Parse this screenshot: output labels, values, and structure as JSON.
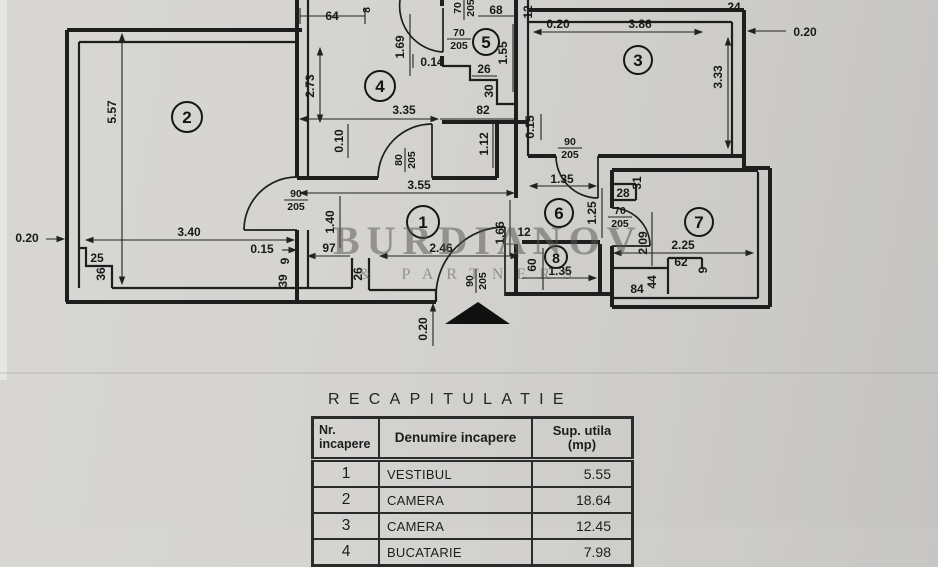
{
  "plan": {
    "rooms": [
      "1",
      "2",
      "3",
      "4",
      "5",
      "6",
      "7",
      "8"
    ],
    "dims": [
      "5.57",
      "0.20",
      "3.40",
      "0.15",
      "25",
      "36",
      "9",
      "39",
      "64",
      "8",
      "2.73",
      "1.69",
      "0.14",
      "68",
      "1.55",
      "26",
      "30",
      "3.35",
      "82",
      "0.10",
      "1.12",
      "12",
      "0.20",
      "3.86",
      "24",
      "0.20",
      "3.33",
      "0.15",
      "1.35",
      "1.25",
      "28",
      "31",
      "3.55",
      "1.40",
      "97",
      "2.46",
      "26",
      "0.20",
      "1.66",
      "12",
      "60",
      "1.35",
      "2.09",
      "2.25",
      "62",
      "9",
      "84",
      "44"
    ],
    "doors": [
      {
        "width": "90",
        "height": "205"
      },
      {
        "width": "80",
        "height": "205"
      },
      {
        "width": "70",
        "height": "205"
      },
      {
        "width": "70",
        "height": "205"
      },
      {
        "width": "90",
        "height": "205"
      },
      {
        "width": "70",
        "height": "205"
      },
      {
        "width": "90",
        "height": "205"
      }
    ]
  },
  "watermark": {
    "line1": "BURDIANOV",
    "line2": "& PARTNERS"
  },
  "table": {
    "title": "RECAPITULATIE",
    "headers": {
      "col1_line1": "Nr.",
      "col1_line2": "incapere",
      "col2": "Denumire incapere",
      "col3_line1": "Sup. utila",
      "col3_line2": "(mp)"
    },
    "rows": [
      {
        "nr": "1",
        "name": "VESTIBUL",
        "area": "5.55"
      },
      {
        "nr": "2",
        "name": "CAMERA",
        "area": "18.64"
      },
      {
        "nr": "3",
        "name": "CAMERA",
        "area": "12.45"
      },
      {
        "nr": "4",
        "name": "BUCATARIE",
        "area": "7.98"
      }
    ]
  }
}
